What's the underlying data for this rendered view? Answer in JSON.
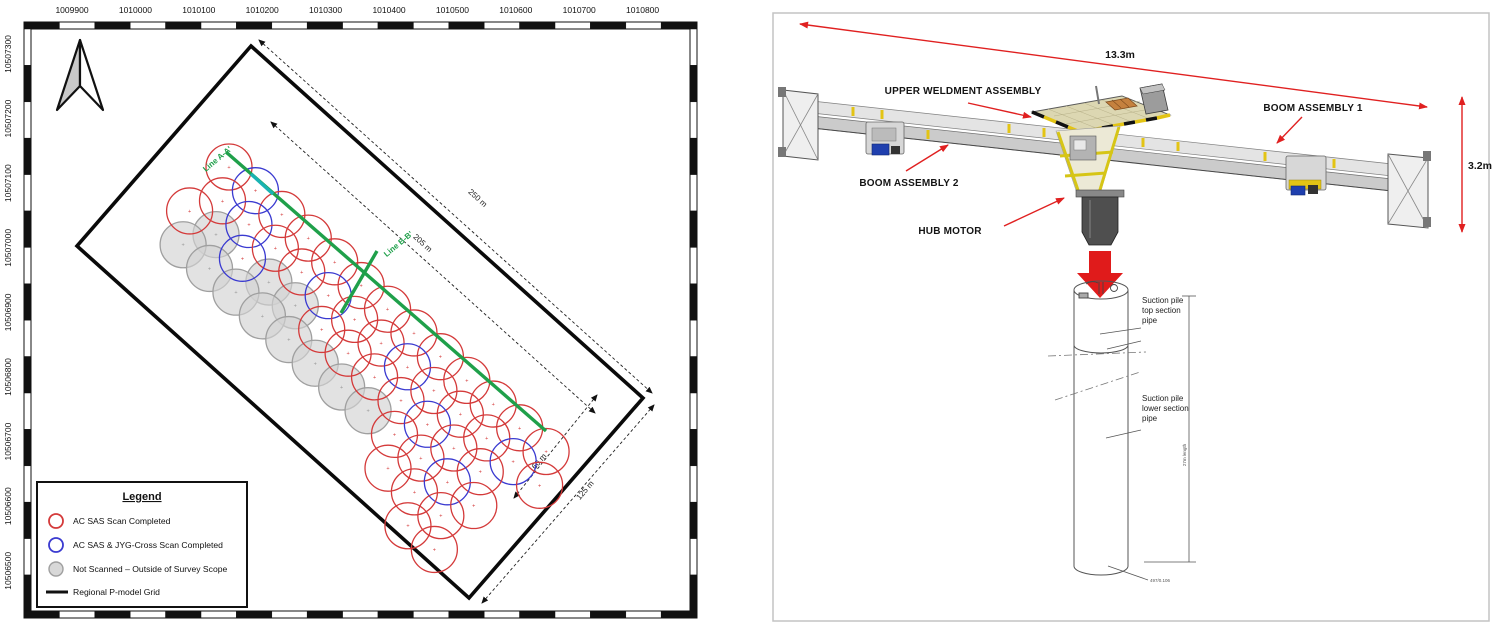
{
  "figure": {
    "map": {
      "x_axis_labels": [
        "1009900",
        "1010000",
        "1010100",
        "1010200",
        "1010300",
        "1010400",
        "1010500",
        "1010600",
        "1010700",
        "1010800"
      ],
      "y_axis_labels": [
        "10507300",
        "10507200",
        "10507100",
        "10507000",
        "10506900",
        "10506800",
        "10506700",
        "10506600",
        "10506500"
      ],
      "section_lines": {
        "line_a": "Line A-A'",
        "line_b": "Line B-B'"
      },
      "dimensions": {
        "long_outer": "250 m",
        "long_inner": "205 m",
        "short_inner": "60 m",
        "short_outer": "125 m"
      },
      "legend": {
        "title": "Legend",
        "items": [
          {
            "label": "AC SAS Scan Completed",
            "marker": "red-ring",
            "stroke": "#d43a3a",
            "fill": "none"
          },
          {
            "label": "AC SAS & JYG-Cross Scan Completed",
            "marker": "blue-ring",
            "stroke": "#3a3ad0",
            "fill": "none"
          },
          {
            "label": "Not Scanned – Outside of Survey Scope",
            "marker": "gray-disc",
            "stroke": "#9f9f9f",
            "fill": "#d8d8d8"
          },
          {
            "label": "Regional P-model Grid",
            "marker": "black-line",
            "stroke": "#111111",
            "fill": "#111111"
          }
        ]
      },
      "survey_grid": {
        "rows": 4,
        "cols": 12,
        "radius": 23,
        "spacing": 35.5,
        "row_step": 29.5,
        "stagger": 17.75,
        "origin": [
          229,
          167
        ],
        "angle_deg": 41.9,
        "gray_cells": [
          [
            2,
            1
          ],
          [
            2,
            3
          ],
          [
            2,
            4
          ],
          [
            3,
            0
          ],
          [
            3,
            1
          ],
          [
            3,
            2
          ],
          [
            3,
            3
          ],
          [
            3,
            4
          ],
          [
            3,
            5
          ],
          [
            3,
            6
          ],
          [
            3,
            7
          ]
        ],
        "blue_cells": [
          [
            0,
            1
          ],
          [
            1,
            1
          ],
          [
            2,
            2
          ],
          [
            1,
            4
          ],
          [
            1,
            7
          ],
          [
            2,
            9
          ],
          [
            1,
            11
          ],
          [
            3,
            10
          ]
        ],
        "extra_cells": [
          [
            0,
            12
          ],
          [
            1,
            12
          ],
          [
            4,
            9
          ],
          [
            4,
            10
          ],
          [
            4,
            11
          ],
          [
            5,
            10
          ],
          [
            5,
            11
          ]
        ],
        "center_marker": "+",
        "colors": {
          "scanned": "#d43a3a",
          "cross_scanned": "#3a3ad0",
          "not_scanned_stroke": "#9f9f9f",
          "not_scanned_fill": "#d3d3d3",
          "line_green": "#1fa04a",
          "line_teal": "#1ab3b3",
          "grid_black": "#0a0a0a"
        }
      }
    },
    "diagram": {
      "labels": {
        "upper_weldment": "UPPER WELDMENT ASSEMBLY",
        "boom1": "BOOM ASSEMBLY 1",
        "boom2": "BOOM ASSEMBLY 2",
        "hub_motor": "HUB MOTOR",
        "width_dim": "13.3m",
        "height_dim": "3.2m"
      },
      "pile": {
        "top_label": "Suction pile top section pipe",
        "lower_label": "Suction pile lower section pipe",
        "length_note": "27m length",
        "base_note": "497/0.106"
      },
      "accent_red": "#e02020"
    }
  }
}
